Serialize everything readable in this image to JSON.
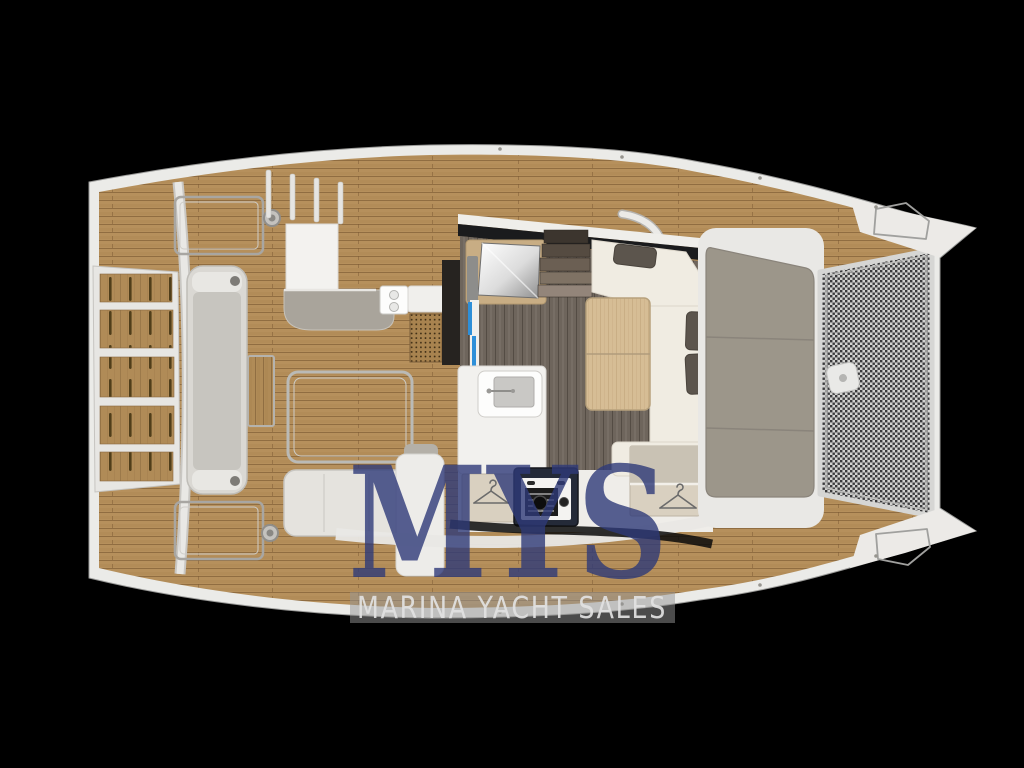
{
  "watermark": {
    "logo_text": "MYS",
    "band_text": "MARINA YACHT SALES",
    "logo_color": "#2e3a78",
    "band_bg_color": "#969696",
    "band_text_color": "#e2e2e2"
  },
  "canvas": {
    "background": "#000000",
    "width": 1024,
    "height": 768
  },
  "palette": {
    "hull_white": "#ebebe8",
    "deck_teak": "#b6905c",
    "teak_plank_line": "#7b5a33",
    "salon_floor_dark": "#6e655c",
    "light_wood_table": "#d6bd95",
    "upholstery_cream": "#f0ece2",
    "cushion_gray": "#5c554d",
    "sunpad_gray": "#9c968a",
    "bench_gray": "#dad8d3",
    "trampoline_mesh": "#d2d2d0",
    "mesh_dot": "#39393b",
    "accent_blue": "#2e8fd8",
    "stove_navy": "#242a38",
    "wardrobe_beige": "#d9d0c0",
    "mirror_frame_beige": "#c8ad84"
  },
  "icon_names": [
    "hanger-icon",
    "winch-icon",
    "cleat-icon",
    "faucet-icon",
    "stove-knob-icon"
  ]
}
